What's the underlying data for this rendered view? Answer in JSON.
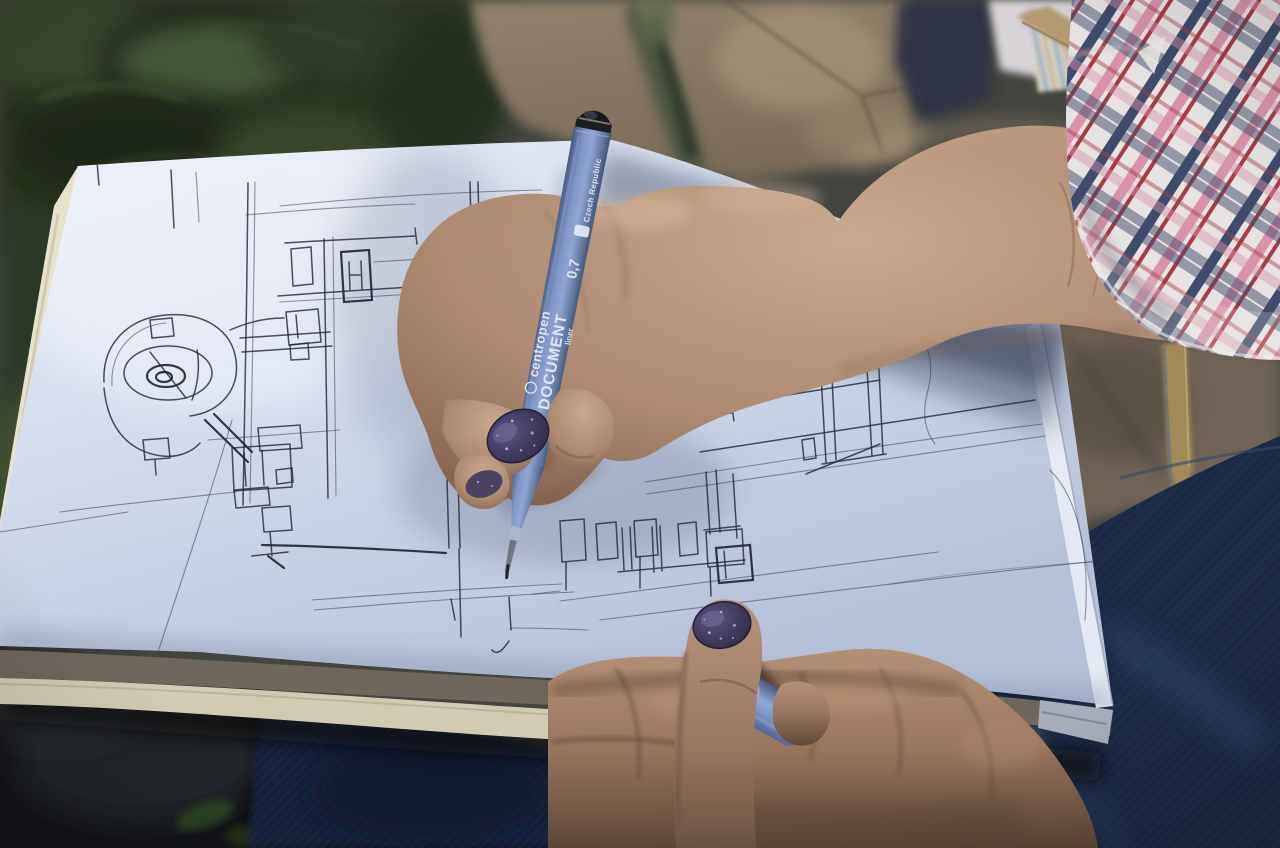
{
  "scene": {
    "type": "photograph",
    "description": "Close-up of a person's hands sketching an architectural perspective drawing in a sketchbook with a blue fineliner pen, outdoors over stone paving and greenery",
    "subject": "hand-drawn architectural sketch in progress"
  },
  "pen": {
    "brand": "centropen",
    "model": "DOCUMENT",
    "tip_size": "0,7",
    "type_label": "liner",
    "origin_label": "Czech Republic",
    "body_color": "#7b92c4",
    "cap_top_color": "#15181e"
  },
  "sketchbook": {
    "content": "architectural perspective sketch with spiral detail, posts and window-like boxes",
    "paper_color": "#d7deee",
    "ink_color": "#232a3e",
    "page_stack_color": "#6f665c",
    "cover_edge_color": "#e8e2cc"
  },
  "colors": {
    "nail_polish": "#413a5e",
    "skin_light": "#c9aa8f",
    "skin_shadow": "#7c604e",
    "denim": "#1b2944",
    "plaid_white": "#e7e3e3",
    "plaid_red": "#a83a48",
    "plaid_pink": "#d893aa",
    "plaid_navy": "#3f4b6b",
    "foliage": "#2c3a24",
    "stone": "#8d7c68"
  }
}
